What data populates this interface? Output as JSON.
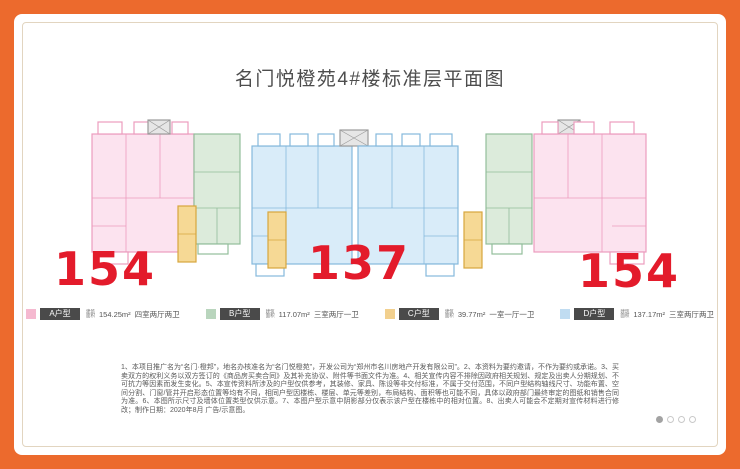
{
  "page": {
    "title": "名门悦橙苑4#楼标准层平面图",
    "colors": {
      "frame_orange": "#ec6a2d",
      "number_red": "#e31b2b",
      "unit_a_pink": "#f5b9d0",
      "unit_b_green": "#b9d5bd",
      "unit_c_yellow": "#f2d08e",
      "unit_d_blue": "#c0dcf1"
    }
  },
  "floorplan": {
    "numbers": [
      "154",
      "137",
      "154"
    ]
  },
  "legend": {
    "items": [
      {
        "id": "A",
        "badge": "A户型",
        "prefix_top": "建筑",
        "prefix_bottom": "面积",
        "area": "154.25m²",
        "rooms": "四室两厅两卫",
        "chip_color": "#f5b9d0"
      },
      {
        "id": "B",
        "badge": "B户型",
        "prefix_top": "建筑",
        "prefix_bottom": "面积",
        "area": "117.07m²",
        "rooms": "三室两厅一卫",
        "chip_color": "#b9d5bd"
      },
      {
        "id": "C",
        "badge": "C户型",
        "prefix_top": "建筑",
        "prefix_bottom": "面积",
        "area": "39.77m²",
        "rooms": "一室一厅一卫",
        "chip_color": "#f2d08e"
      },
      {
        "id": "D",
        "badge": "D户型",
        "prefix_top": "建筑",
        "prefix_bottom": "面积",
        "area": "137.17m²",
        "rooms": "三室两厅两卫",
        "chip_color": "#c0dcf1"
      }
    ]
  },
  "disclaimer": {
    "text": "1、本项目推广名为“名门·橙邦”，地名办核准名为“名门悦橙苑”，开发公司为“郑州市名川房地产开发有限公司”。2、本资料为要约邀请，不作为要约或承诺。3、买卖双方的权利义务以双方签订的《商品房买卖合同》及其补充协议、附件等书面文件为准。4、相关宣传内容不排除因政府相关规划、规定及出卖人分期规划、不可抗力等因素而发生变化。5、本宣传资料所涉及的户型仅供参考，其装修、家具、陈设等非交付标准，不属于交付范围，不同户型结构轴线尺寸、功能布置、空间分割、门窗/管井开启形态位置等均有不同，相同户型因楼栋、楼层、单元等差别，布局结构、面积等也可能不同，具体以政府部门最终审定的图纸和销售合同为准。6、本图所示尺寸及墙体位置类型仅供示意。7、本图户型示意中阴影部分仅表示该户型在楼栋中的相对位置。8、出卖人可能会不定期对宣传材料进行修改；制作日期：2020年8月 广告/示意图。"
  },
  "pagination": {
    "total": 4,
    "active_index": 0
  }
}
